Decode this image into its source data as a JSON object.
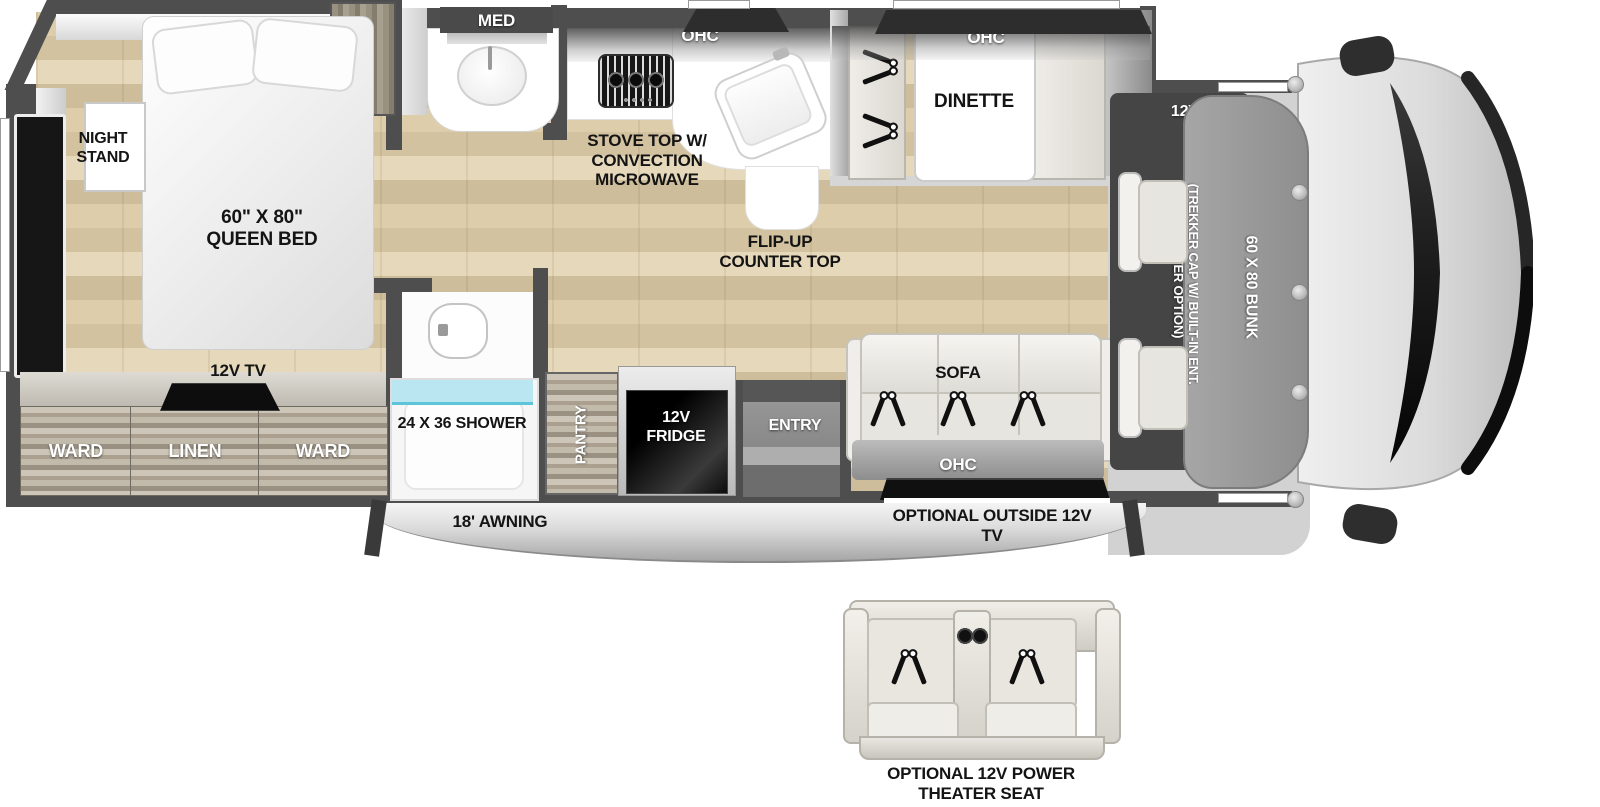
{
  "colors": {
    "wall": "#4e4e4e",
    "floor_wood": "#d9c9a7",
    "shower_glass": "#aee3ef",
    "label_dark": "#141414",
    "label_light": "#ffffff"
  },
  "bedroom": {
    "night_stand": "NIGHT STAND",
    "queen_bed": "60\" X 80\" QUEEN BED",
    "closet": "CLOSET",
    "tv": "12V TV",
    "ward_left": "WARD",
    "linen": "LINEN",
    "ward_right": "WARD"
  },
  "bathroom": {
    "med_cabinet": "MED",
    "shower": "24 X 36 SHOWER"
  },
  "kitchen": {
    "ohc": "OHC",
    "stove": "STOVE TOP W/ CONVECTION MICROWAVE",
    "flip_up_counter": "FLIP-UP COUNTER TOP",
    "pantry": "PANTRY",
    "fridge": "12V FRIDGE"
  },
  "dinette": {
    "ohc": "OHC",
    "label": "DINETTE"
  },
  "living": {
    "sofa": "SOFA",
    "ohc": "OHC",
    "outside_tv": "OPTIONAL OUTSIDE 12V TV"
  },
  "entry": {
    "label": "ENTRY"
  },
  "cab": {
    "tv": "12V TV",
    "trekker_cap": "(TREKKER CAP W/ BUILT-IN ENT. CENTER OPTION)",
    "bunk": "60 X 80 BUNK"
  },
  "exterior": {
    "awning": "18' AWNING",
    "theater_seat_option": "OPTIONAL 12V POWER THEATER SEAT"
  }
}
